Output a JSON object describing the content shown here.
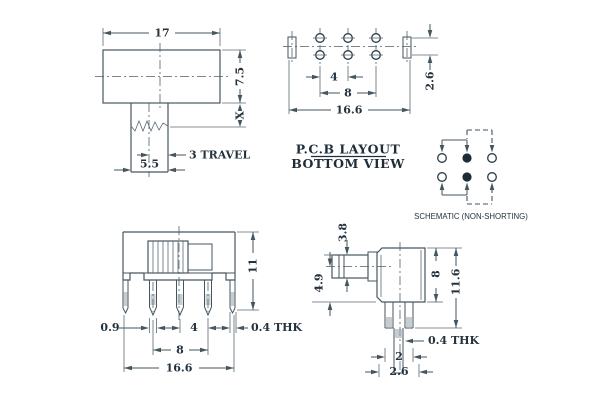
{
  "colors": {
    "line": "#46565f",
    "text": "#24323d",
    "background": "#ffffff"
  },
  "views": {
    "top": {
      "width": "17",
      "height": "7.5",
      "stem": "X",
      "travel": "3 TRAVEL",
      "knob_width": "5.5"
    },
    "pcb": {
      "pitch": "4",
      "span": "8",
      "total": "16.6",
      "row_gap": "2.6",
      "title_line1": "P.C.B LAYOUT",
      "title_line2": "BOTTOM VIEW"
    },
    "schematic": {
      "caption": "SCHEMATIC (NON-SHORTING)"
    },
    "front": {
      "height": "11",
      "pin_width": "0.9",
      "pitch": "4",
      "span": "8",
      "tab_thickness": "0.4 THK",
      "total": "16.6"
    },
    "side": {
      "knob_height": "3.8",
      "knob_offset": "4.9",
      "body_height": "8",
      "total_height": "11.6",
      "pin_thickness": "0.4 THK",
      "pin_gap": "2",
      "pin_gap_outer": "2.6"
    }
  }
}
